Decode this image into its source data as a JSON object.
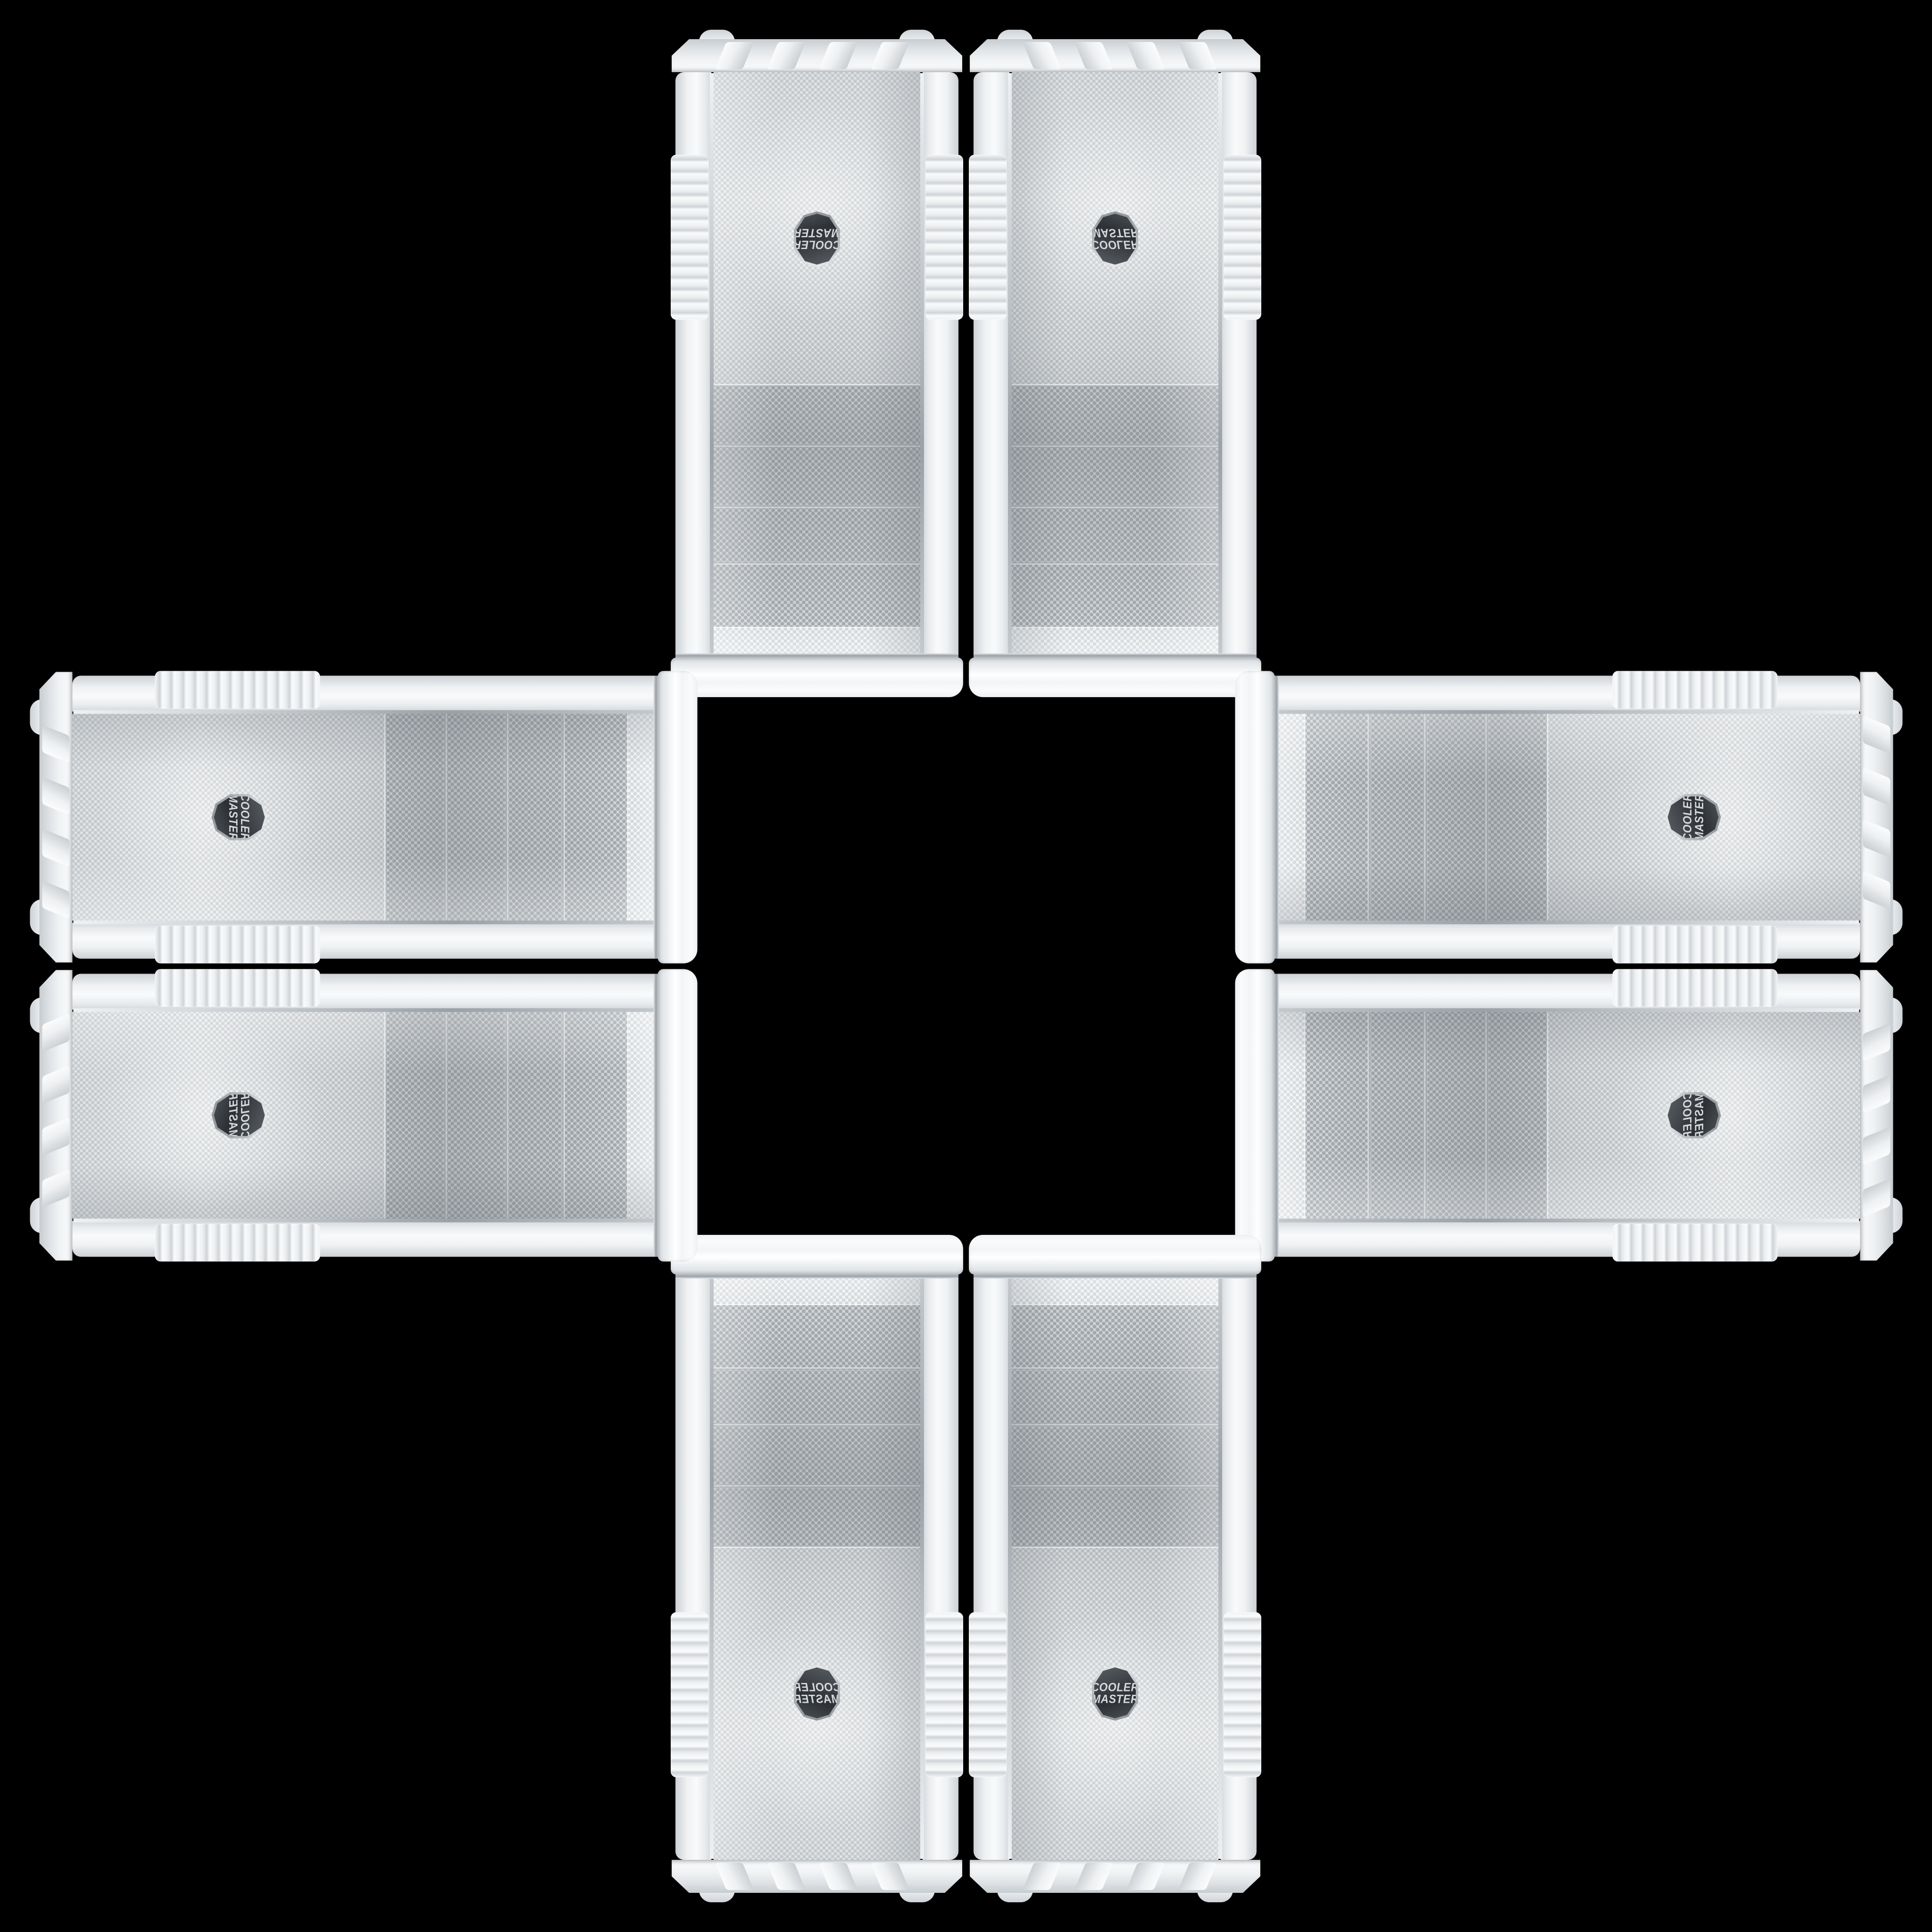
{
  "image_type": "product-photo collage",
  "description": "Eight identical white Cooler Master mid-tower PC cases with perforated mesh front panels, mirrored and rotated into a cross / plus pattern on a black background",
  "background_color": "#000000",
  "brand": {
    "line1": "COOLER",
    "line2": "MASTER",
    "full_name": "Cooler Master"
  },
  "case": {
    "color": "white",
    "badge_text": "COOLER MASTER",
    "front_features": [
      "top vent strip",
      "4 mesh drive-bay covers",
      "large fan intake mesh",
      "hexagonal badge",
      "chrome trim lines",
      "ribbed side-rail grips",
      "notched base",
      "corner feet"
    ]
  },
  "cases": [
    {
      "id": "top-left",
      "orientation": "vertical",
      "mirror": "rotated-180",
      "base_points": "up"
    },
    {
      "id": "top-right",
      "orientation": "vertical",
      "mirror": "flipped-vertically",
      "base_points": "up"
    },
    {
      "id": "bottom-left",
      "orientation": "vertical",
      "mirror": "flipped-horizontally",
      "base_points": "down"
    },
    {
      "id": "bottom-right",
      "orientation": "vertical",
      "mirror": "original",
      "base_points": "down"
    },
    {
      "id": "left-top",
      "orientation": "horizontal",
      "mirror": "rotated-90-cw",
      "base_points": "left"
    },
    {
      "id": "left-bottom",
      "orientation": "horizontal",
      "mirror": "rotated-90-cw-mirrored",
      "base_points": "left"
    },
    {
      "id": "right-top",
      "orientation": "horizontal",
      "mirror": "rotated-90-ccw",
      "base_points": "right"
    },
    {
      "id": "right-bottom",
      "orientation": "horizontal",
      "mirror": "rotated-90-ccw-mirrored",
      "base_points": "right"
    }
  ],
  "case_count": 8,
  "colors": {
    "c-bg": "#000000",
    "c-body-hi": "#fafbfc",
    "c-body-mid": "#eceff1",
    "c-body-lo": "#cfd4d8",
    "c-mesh-bay-bg": "#d6dadd",
    "c-mesh-bay-dot": "#a6abaf",
    "c-mesh-fan-bg": "#eef0f1",
    "c-mesh-fan-dot": "#c6cacd",
    "c-chrome-hi": "#e2e6e9",
    "c-chrome-lo": "#9aa1a7",
    "c-badge-bg": "#3a3e42",
    "c-badge-text": "#d6d9dc"
  }
}
